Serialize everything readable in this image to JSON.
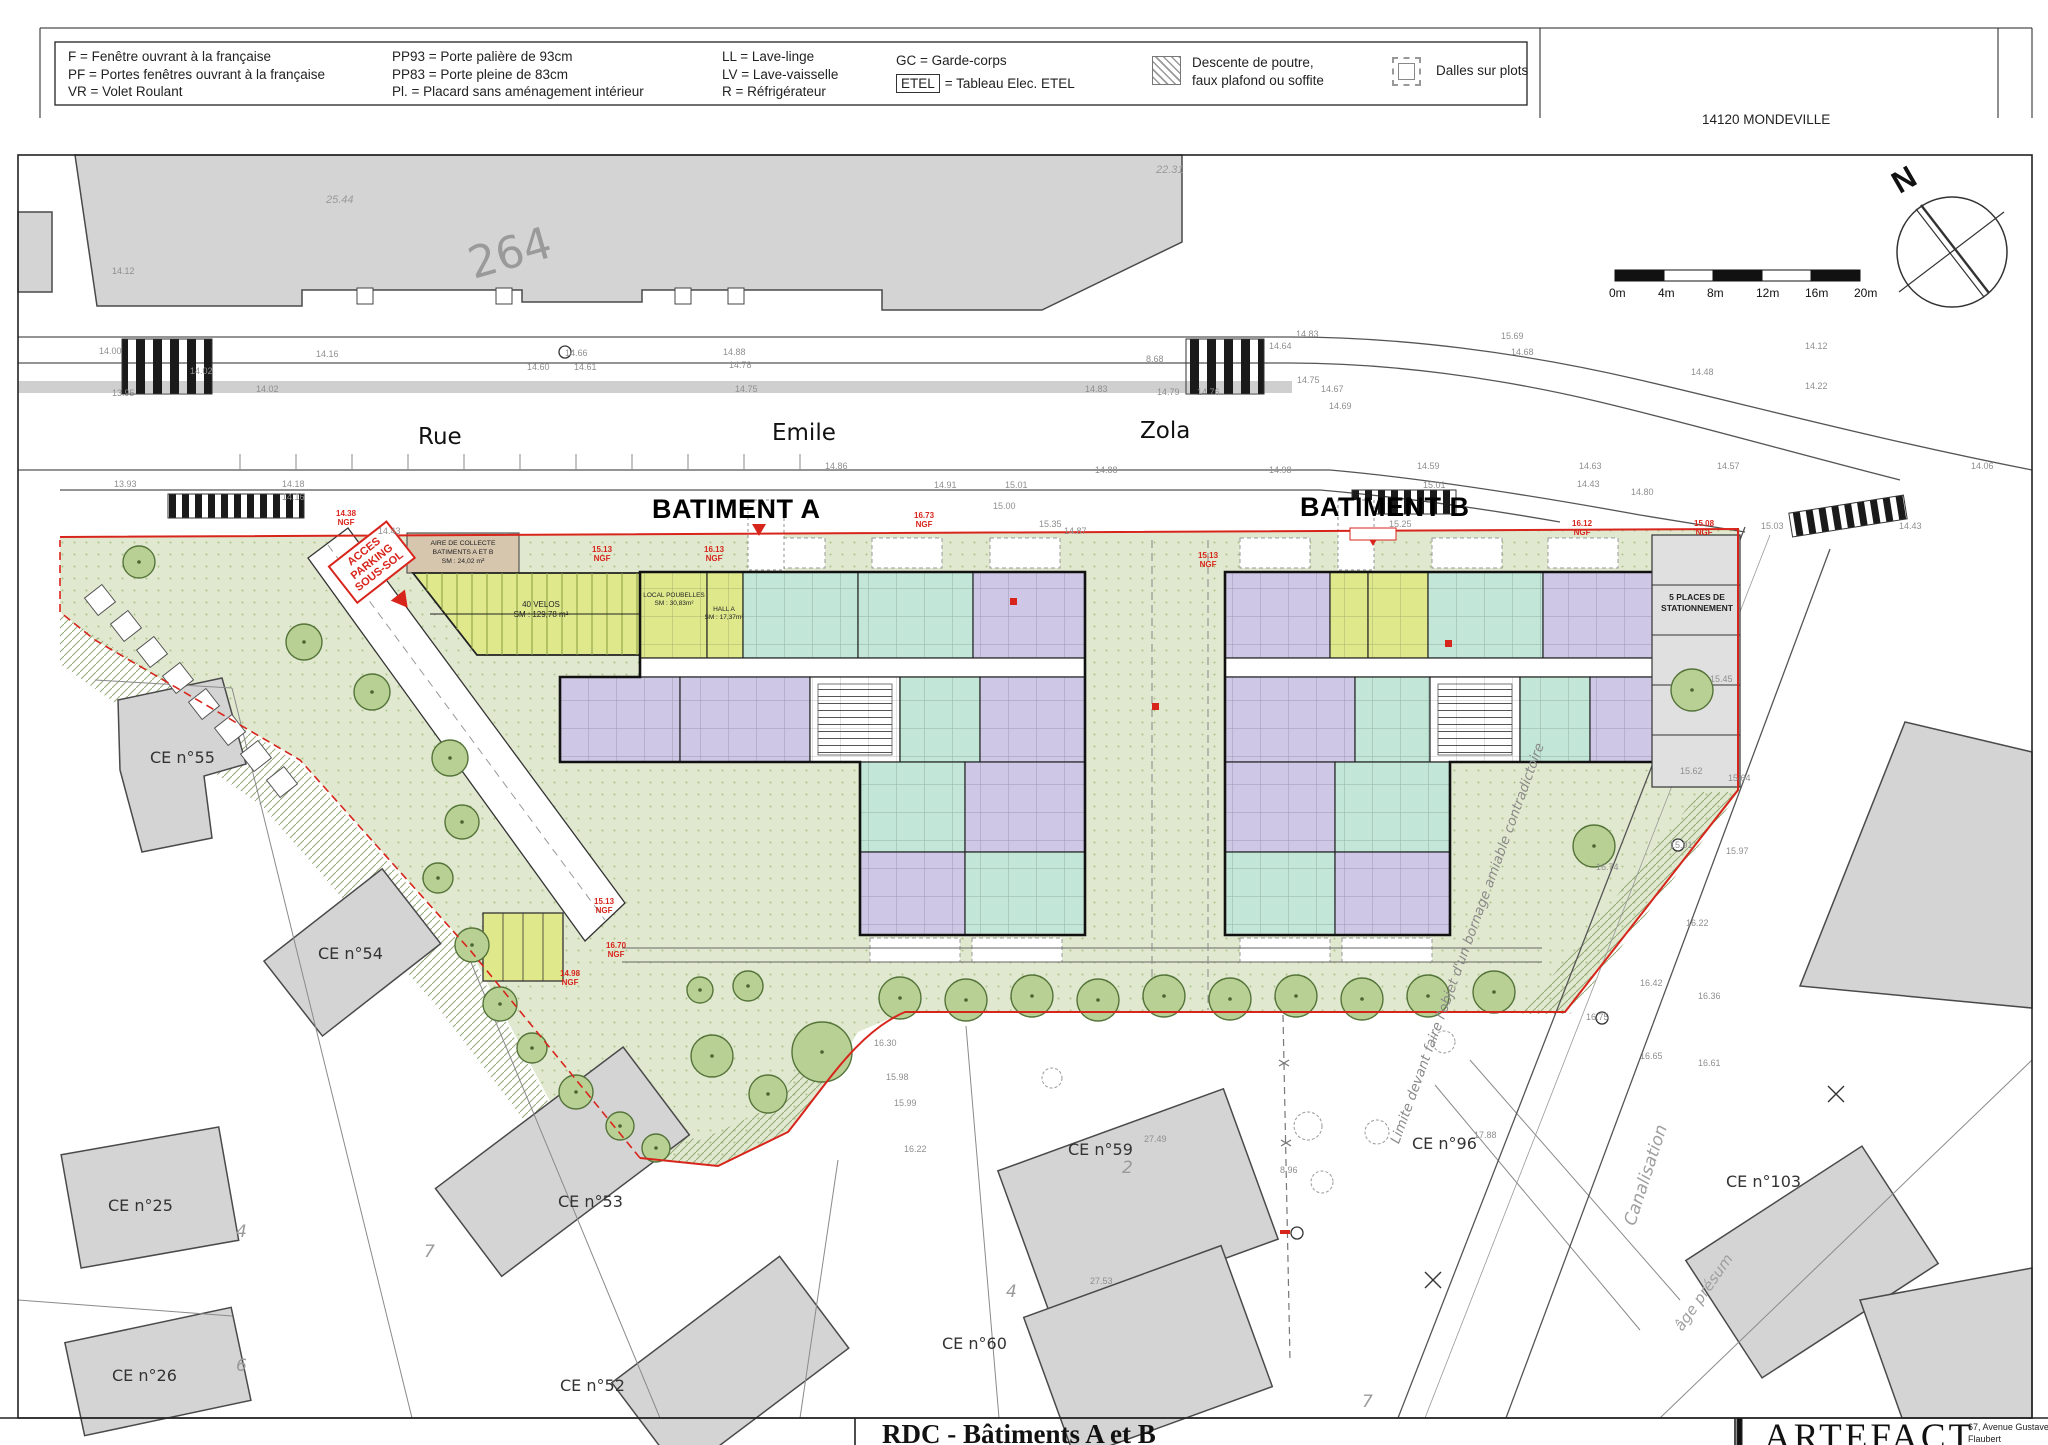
{
  "header": {
    "city": "14120 MONDEVILLE",
    "legend": {
      "cols": [
        {
          "lines": [
            "F = Fenêtre ouvrant à la française",
            "PF = Portes fenêtres ouvrant à la française",
            "VR = Volet Roulant"
          ]
        },
        {
          "lines": [
            "PP93 = Porte palière de 93cm",
            "PP83 = Porte pleine de 83cm",
            "Pl. = Placard sans aménagement intérieur"
          ]
        },
        {
          "lines": [
            "LL = Lave-linge",
            "LV = Lave-vaisselle",
            "R = Réfrigérateur"
          ]
        },
        {
          "lines": [
            "GC = Garde-corps"
          ]
        }
      ],
      "etel_tag": "ETEL",
      "etel_desc": "= Tableau Elec. ETEL",
      "hatch_lines": [
        "Descente de poutre,",
        "faux plafond ou soffite"
      ],
      "plots_label": "Dalles sur plots"
    }
  },
  "plan": {
    "parcel_number": "264",
    "street": {
      "rue": "Rue",
      "emile": "Emile",
      "zola": "Zola"
    },
    "batiment_a": "BATIMENT A",
    "batiment_b": "BATIMENT B",
    "north_letter": "N",
    "scale": {
      "ticks": [
        "0m",
        "4m",
        "8m",
        "12m",
        "16m",
        "20m"
      ]
    },
    "parking_label": [
      "5 PLACES DE",
      "STATIONNEMENT"
    ],
    "access_parking": [
      "ACCES",
      "PARKING",
      "SOUS-SOL"
    ],
    "aire_collecte": [
      "AIRE DE COLLECTE",
      "BATIMENTS A ET B",
      "SM : 24,02 m²"
    ],
    "velos": [
      "40 VELOS",
      "SM : 129,78 m²"
    ],
    "local_poubelles": [
      "LOCAL POUBELLES",
      "SM : 30,83m²"
    ],
    "hall_a": [
      "HALL A",
      "SM : 17,37m²"
    ],
    "limite_note": "Limite devant faire l'objet d'un bornage amiable contradictoire",
    "canalisation": "Canalisation",
    "age_presum": "âge présum",
    "ngf_suffix": "NGF",
    "colors": {
      "teal_unit": "#c2e6d8",
      "lavender_unit": "#cfc7e6",
      "lime_common": "#dfe98c",
      "site_green": "#e0e9cf",
      "tan_collecte": "#d6c6ae",
      "red_marking": "#d8251c",
      "neighbor_gray": "#d4d4d4"
    },
    "ce_labels": [
      {
        "t": "CE n°55",
        "x": 150,
        "y": 748
      },
      {
        "t": "CE n°54",
        "x": 318,
        "y": 944
      },
      {
        "t": "CE n°25",
        "x": 108,
        "y": 1196
      },
      {
        "t": "CE n°26",
        "x": 112,
        "y": 1366
      },
      {
        "t": "CE n°53",
        "x": 558,
        "y": 1192
      },
      {
        "t": "CE n°52",
        "x": 560,
        "y": 1376
      },
      {
        "t": "CE n°59",
        "x": 1068,
        "y": 1140
      },
      {
        "t": "CE n°60",
        "x": 942,
        "y": 1334
      },
      {
        "t": "CE n°96",
        "x": 1412,
        "y": 1134
      },
      {
        "t": "CE n°103",
        "x": 1726,
        "y": 1172
      }
    ],
    "ngf_labels": [
      {
        "t": "14.38",
        "x": 336,
        "y": 510
      },
      {
        "t": "15.13",
        "x": 592,
        "y": 546
      },
      {
        "t": "16.13",
        "x": 704,
        "y": 546
      },
      {
        "t": "16.73",
        "x": 914,
        "y": 512
      },
      {
        "t": "15.13",
        "x": 1198,
        "y": 552
      },
      {
        "t": "16.12",
        "x": 1572,
        "y": 520
      },
      {
        "t": "15.08",
        "x": 1694,
        "y": 520
      },
      {
        "t": "15.13",
        "x": 594,
        "y": 898
      },
      {
        "t": "16.70",
        "x": 606,
        "y": 942
      },
      {
        "t": "14.98",
        "x": 560,
        "y": 970
      }
    ],
    "roof_numbers": [
      {
        "t": "25.44",
        "x": 326,
        "y": 194
      },
      {
        "t": "22.31",
        "x": 1156,
        "y": 164
      }
    ],
    "parcel_marks": [
      {
        "t": "4",
        "x": 236,
        "y": 1222
      },
      {
        "t": "6",
        "x": 236,
        "y": 1356
      },
      {
        "t": "7",
        "x": 424,
        "y": 1242
      },
      {
        "t": "2",
        "x": 1122,
        "y": 1158
      },
      {
        "t": "4",
        "x": 1006,
        "y": 1282
      },
      {
        "t": "7",
        "x": 1362,
        "y": 1392
      }
    ],
    "elevations": [
      {
        "t": "14.12",
        "x": 112,
        "y": 266
      },
      {
        "t": "14.00",
        "x": 99,
        "y": 346
      },
      {
        "t": "13.95",
        "x": 112,
        "y": 388
      },
      {
        "t": "14.02",
        "x": 190,
        "y": 366
      },
      {
        "t": "14.16",
        "x": 316,
        "y": 349
      },
      {
        "t": "14.02",
        "x": 256,
        "y": 384
      },
      {
        "t": "14.66",
        "x": 565,
        "y": 348
      },
      {
        "t": "14.60",
        "x": 527,
        "y": 362
      },
      {
        "t": "14.61",
        "x": 574,
        "y": 362
      },
      {
        "t": "14.88",
        "x": 723,
        "y": 347
      },
      {
        "t": "14.78",
        "x": 729,
        "y": 360
      },
      {
        "t": "14.75",
        "x": 735,
        "y": 384
      },
      {
        "t": "8.68",
        "x": 1146,
        "y": 354
      },
      {
        "t": "14.83",
        "x": 1085,
        "y": 384
      },
      {
        "t": "14.79",
        "x": 1157,
        "y": 387
      },
      {
        "t": "14.76",
        "x": 1197,
        "y": 387
      },
      {
        "t": "14.64",
        "x": 1269,
        "y": 341
      },
      {
        "t": "14.83",
        "x": 1296,
        "y": 329
      },
      {
        "t": "14.75",
        "x": 1297,
        "y": 375
      },
      {
        "t": "14.67",
        "x": 1321,
        "y": 384
      },
      {
        "t": "14.69",
        "x": 1329,
        "y": 401
      },
      {
        "t": "15.69",
        "x": 1501,
        "y": 331
      },
      {
        "t": "14.68",
        "x": 1511,
        "y": 347
      },
      {
        "t": "14.12",
        "x": 1805,
        "y": 341
      },
      {
        "t": "14.48",
        "x": 1691,
        "y": 367
      },
      {
        "t": "14.22",
        "x": 1805,
        "y": 381
      },
      {
        "t": "14.06",
        "x": 1971,
        "y": 461
      },
      {
        "t": "14.43",
        "x": 1899,
        "y": 521
      },
      {
        "t": "14.63",
        "x": 1579,
        "y": 461
      },
      {
        "t": "14.57",
        "x": 1717,
        "y": 461
      },
      {
        "t": "14.43",
        "x": 1577,
        "y": 479
      },
      {
        "t": "14.59",
        "x": 1417,
        "y": 461
      },
      {
        "t": "14.88",
        "x": 1095,
        "y": 465
      },
      {
        "t": "15.01",
        "x": 1005,
        "y": 480
      },
      {
        "t": "15.00",
        "x": 993,
        "y": 501
      },
      {
        "t": "15.35",
        "x": 1039,
        "y": 519
      },
      {
        "t": "15.25",
        "x": 1389,
        "y": 519
      },
      {
        "t": "15.03",
        "x": 1761,
        "y": 521
      },
      {
        "t": "15.01",
        "x": 1423,
        "y": 480
      },
      {
        "t": "14.98",
        "x": 1269,
        "y": 465
      },
      {
        "t": "14.86",
        "x": 825,
        "y": 461
      },
      {
        "t": "14.91",
        "x": 934,
        "y": 480
      },
      {
        "t": "14.80",
        "x": 1631,
        "y": 487
      },
      {
        "t": "14.87",
        "x": 1064,
        "y": 526
      },
      {
        "t": "14.43",
        "x": 378,
        "y": 526
      },
      {
        "t": "14.18",
        "x": 282,
        "y": 479
      },
      {
        "t": "14.16",
        "x": 282,
        "y": 492
      },
      {
        "t": "13.93",
        "x": 114,
        "y": 479
      },
      {
        "t": "15.62",
        "x": 1680,
        "y": 766
      },
      {
        "t": "15.64",
        "x": 1728,
        "y": 773
      },
      {
        "t": "15.91",
        "x": 1670,
        "y": 840
      },
      {
        "t": "15.97",
        "x": 1726,
        "y": 846
      },
      {
        "t": "16.22",
        "x": 1686,
        "y": 918
      },
      {
        "t": "16.42",
        "x": 1640,
        "y": 978
      },
      {
        "t": "16.36",
        "x": 1698,
        "y": 991
      },
      {
        "t": "16.75",
        "x": 1586,
        "y": 1012
      },
      {
        "t": "16.61",
        "x": 1698,
        "y": 1058
      },
      {
        "t": "16.65",
        "x": 1640,
        "y": 1051
      },
      {
        "t": "16.74",
        "x": 1596,
        "y": 862
      },
      {
        "t": "15.45",
        "x": 1710,
        "y": 674
      },
      {
        "t": "17.88",
        "x": 1474,
        "y": 1130
      },
      {
        "t": "8.96",
        "x": 1280,
        "y": 1165
      },
      {
        "t": "27.49",
        "x": 1144,
        "y": 1134
      },
      {
        "t": "27.53",
        "x": 1090,
        "y": 1276
      },
      {
        "t": "16.30",
        "x": 874,
        "y": 1038
      },
      {
        "t": "15.98",
        "x": 886,
        "y": 1072
      },
      {
        "t": "15.99",
        "x": 894,
        "y": 1098
      },
      {
        "t": "16.22",
        "x": 904,
        "y": 1144
      }
    ],
    "trees": [
      {
        "x": 139,
        "y": 562,
        "r": 16
      },
      {
        "x": 304,
        "y": 642,
        "r": 18
      },
      {
        "x": 372,
        "y": 692,
        "r": 18
      },
      {
        "x": 450,
        "y": 758,
        "r": 18
      },
      {
        "x": 462,
        "y": 822,
        "r": 17
      },
      {
        "x": 438,
        "y": 878,
        "r": 15
      },
      {
        "x": 472,
        "y": 945,
        "r": 17
      },
      {
        "x": 500,
        "y": 1004,
        "r": 17
      },
      {
        "x": 532,
        "y": 1048,
        "r": 15
      },
      {
        "x": 576,
        "y": 1092,
        "r": 17
      },
      {
        "x": 620,
        "y": 1126,
        "r": 14
      },
      {
        "x": 822,
        "y": 1052,
        "r": 30
      },
      {
        "x": 768,
        "y": 1094,
        "r": 19
      },
      {
        "x": 712,
        "y": 1056,
        "r": 21
      },
      {
        "x": 748,
        "y": 986,
        "r": 15
      },
      {
        "x": 700,
        "y": 990,
        "r": 13
      },
      {
        "x": 656,
        "y": 1148,
        "r": 14
      },
      {
        "x": 900,
        "y": 998,
        "r": 21
      },
      {
        "x": 966,
        "y": 1000,
        "r": 21
      },
      {
        "x": 1032,
        "y": 996,
        "r": 21
      },
      {
        "x": 1098,
        "y": 1000,
        "r": 21
      },
      {
        "x": 1164,
        "y": 996,
        "r": 21
      },
      {
        "x": 1230,
        "y": 999,
        "r": 21
      },
      {
        "x": 1296,
        "y": 996,
        "r": 21
      },
      {
        "x": 1362,
        "y": 999,
        "r": 21
      },
      {
        "x": 1428,
        "y": 996,
        "r": 21
      },
      {
        "x": 1494,
        "y": 992,
        "r": 21
      },
      {
        "x": 1594,
        "y": 846,
        "r": 21
      },
      {
        "x": 1692,
        "y": 690,
        "r": 21
      },
      {
        "x": 1308,
        "y": 1126,
        "r": 14,
        "s": 1
      },
      {
        "x": 1377,
        "y": 1132,
        "r": 12,
        "s": 1
      },
      {
        "x": 1322,
        "y": 1182,
        "r": 11,
        "s": 1
      },
      {
        "x": 1444,
        "y": 1042,
        "r": 11,
        "s": 1
      },
      {
        "x": 1052,
        "y": 1078,
        "r": 10,
        "s": 1
      }
    ]
  },
  "title_block": {
    "title": "RDC - Bâtiments A et B",
    "firm": "ARTEFACT",
    "address": "67, Avenue Gustave Flaubert"
  }
}
